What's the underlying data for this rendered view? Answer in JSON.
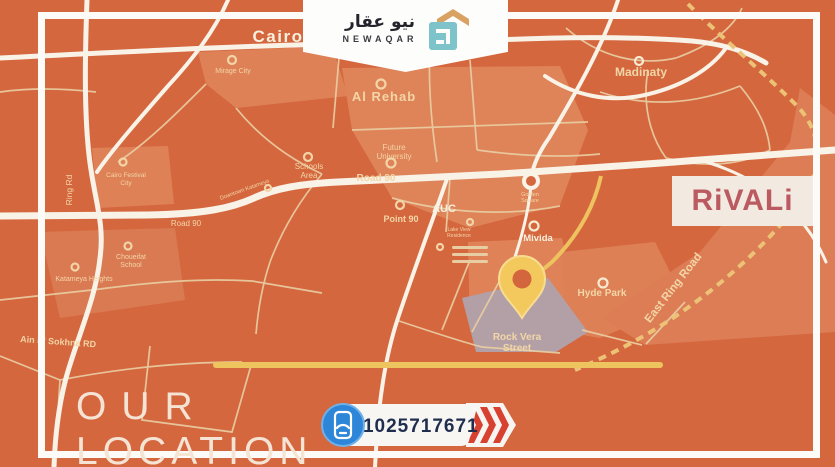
{
  "header_logo": {
    "arabic": "نيو عقار",
    "latin": "NEWAQAR"
  },
  "project": {
    "name": "RiVALi"
  },
  "footer": {
    "caption_line1": "OUR",
    "caption_line2": "LOCATION",
    "phone": "01025717671"
  },
  "map": {
    "labels": {
      "cairo": "Cairo",
      "madinaty": "Madinaty",
      "al_rehab": "Al Rehab",
      "mirage_city": "Mirage City",
      "future_university_1": "Future",
      "future_university_2": "University",
      "road_90_center": "Road 90",
      "road_90_west": "Road 90",
      "schools_area_1": "Schools",
      "schools_area_2": "Area",
      "auc": "AUC",
      "point_90": "Point 90",
      "mivida": "Mivida",
      "golden_square_1": "Golden",
      "golden_square_2": "Square",
      "hyde_park": "Hyde Park",
      "rock_vera_1": "Rock Vera",
      "rock_vera_2": "Street",
      "east_ring_road": "East Ring Road",
      "ring_rd": "Ring Rd",
      "ain_el_sokhna": "Ain El Sokhna RD",
      "cairo_festival_1": "Cairo Festival",
      "cairo_festival_2": "City",
      "choueifat_1": "Choueifat",
      "choueifat_2": "School",
      "katameya_heights": "Katameya Heights",
      "downtown_katameya": "Downtown Katameya",
      "lake_view_1": "Lake View",
      "lake_view_2": "Residence"
    },
    "colors": {
      "background": "#d5673f",
      "region_light": "#de8157",
      "road_white": "#f8f2e7",
      "road_cream": "#e9cda2",
      "road_gold": "#eec25e",
      "rock_vera_region": "#b3a0a7",
      "pin": "#f3c85c",
      "label_cream": "#f2d5a4",
      "phone_blue": "#2e86d8",
      "phone_navy": "#1f2d4e",
      "chevron_red": "#d8402f",
      "rivali_text": "#bb5a61"
    }
  }
}
